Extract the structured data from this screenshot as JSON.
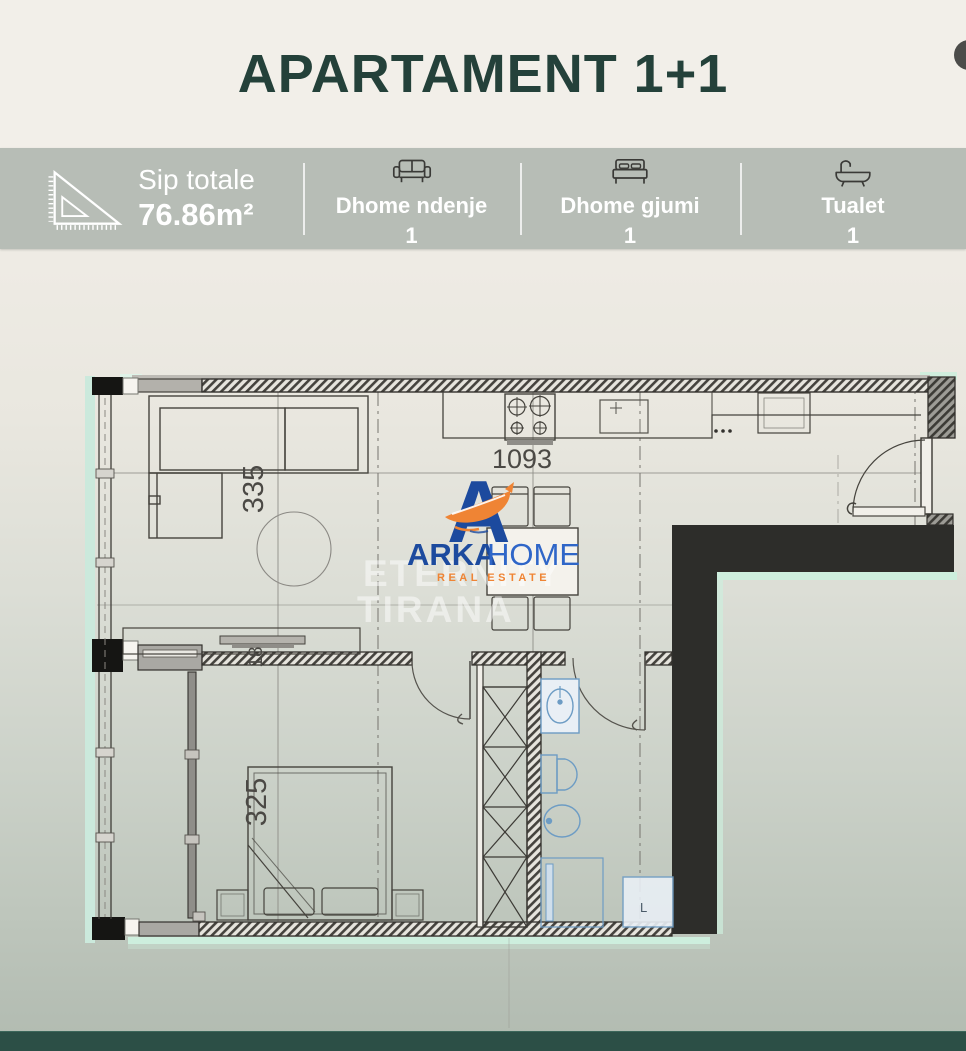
{
  "header": {
    "title": "APARTAMENT 1+1"
  },
  "stats": [
    {
      "icon": "ruler-triangle-icon",
      "label": "Sip totale",
      "value": "76.86m²"
    },
    {
      "icon": "sofa-icon",
      "label": "Dhome ndenje",
      "value": "1"
    },
    {
      "icon": "bed-icon",
      "label": "Dhome gjumi",
      "value": "1"
    },
    {
      "icon": "bathtub-icon",
      "label": "Tualet",
      "value": "1"
    }
  ],
  "floor_plan": {
    "dim_living_width": "335",
    "dim_kitchen_width": "1093",
    "dim_bedroom_width": "325",
    "dim_wall": "18",
    "washer_label": "L",
    "watermark_line1": "ETERNITY",
    "watermark_line2": "TIRANA",
    "logo": {
      "brand_primary": "ARKA",
      "brand_secondary": "HOME",
      "tagline": "REAL ESTATE"
    }
  },
  "colors": {
    "title_green": "#24413a",
    "band_bg": "#b7bdb6",
    "wall_black": "#2d2d2a",
    "mint_highlight": "#cdeedd",
    "fixture_blue": "#6d9cc4",
    "logo_blue": "#1c4a9e",
    "logo_light_blue": "#2f66c8",
    "logo_orange": "#ef8434",
    "footer_bar": "#2c4f46"
  }
}
